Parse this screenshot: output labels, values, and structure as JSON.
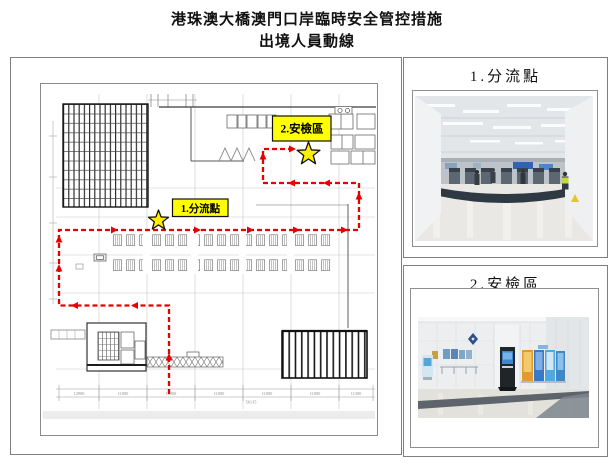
{
  "title": {
    "line1": "港珠澳大橋澳門口岸臨時安全管控措施",
    "line2": "出境人員動線"
  },
  "panels": [
    {
      "title": "1.分流點"
    },
    {
      "title": "2.安檢區"
    }
  ],
  "plan": {
    "label1": "1.分流點",
    "label2": "2.安檢區",
    "dimensions": [
      "12900",
      "11000",
      "11000",
      "11000",
      "11000",
      "11000",
      "11300"
    ],
    "total_dimension": "56135"
  },
  "colors": {
    "highlight_yellow": "#ffff00",
    "route_red": "#e60000",
    "star_yellow": "#ffee00"
  }
}
